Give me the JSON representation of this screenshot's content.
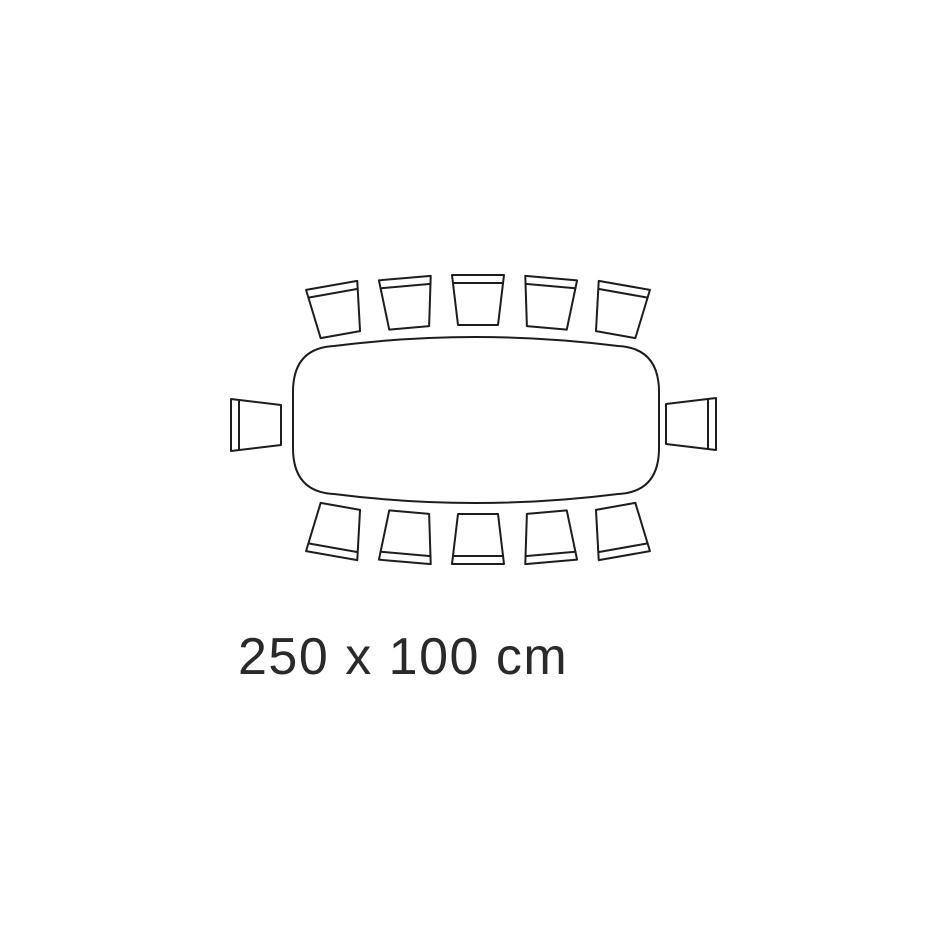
{
  "diagram": {
    "label": "250 x 100 cm",
    "table_width_cm": 250,
    "table_depth_cm": 100,
    "seat_count": 12,
    "colors": {
      "background": "#ffffff",
      "line": "#1d1d1d",
      "text": "#2a2a2a"
    },
    "table_path": "M 293,448 L 293,392 Q 293,348 334,346 Q 476,328 618,346 Q 659,348 659,392 L 659,448 Q 659,492 618,494 Q 476,512 334,494 Q 293,492 293,448 Z",
    "chair": {
      "outline_path": "M -26,-25 L 26,-25 L 20,25 L -20,25 Z",
      "back_line_path": "M -25,-17 L 25,-17"
    },
    "chairs": [
      {
        "side": "top",
        "x": 336,
        "y": 310,
        "rotate": -10
      },
      {
        "side": "top",
        "x": 407,
        "y": 303,
        "rotate": -5
      },
      {
        "side": "top",
        "x": 478,
        "y": 300,
        "rotate": 0
      },
      {
        "side": "top",
        "x": 549,
        "y": 303,
        "rotate": 5
      },
      {
        "side": "top",
        "x": 620,
        "y": 310,
        "rotate": 10
      },
      {
        "side": "left",
        "x": 256,
        "y": 425,
        "rotate": -90
      },
      {
        "side": "right",
        "x": 691,
        "y": 424,
        "rotate": 90
      },
      {
        "side": "bottom",
        "x": 336,
        "y": 531,
        "rotate": 190
      },
      {
        "side": "bottom",
        "x": 407,
        "y": 537,
        "rotate": 185
      },
      {
        "side": "bottom",
        "x": 478,
        "y": 539,
        "rotate": 180
      },
      {
        "side": "bottom",
        "x": 549,
        "y": 537,
        "rotate": 175
      },
      {
        "side": "bottom",
        "x": 620,
        "y": 531,
        "rotate": 170
      }
    ]
  }
}
